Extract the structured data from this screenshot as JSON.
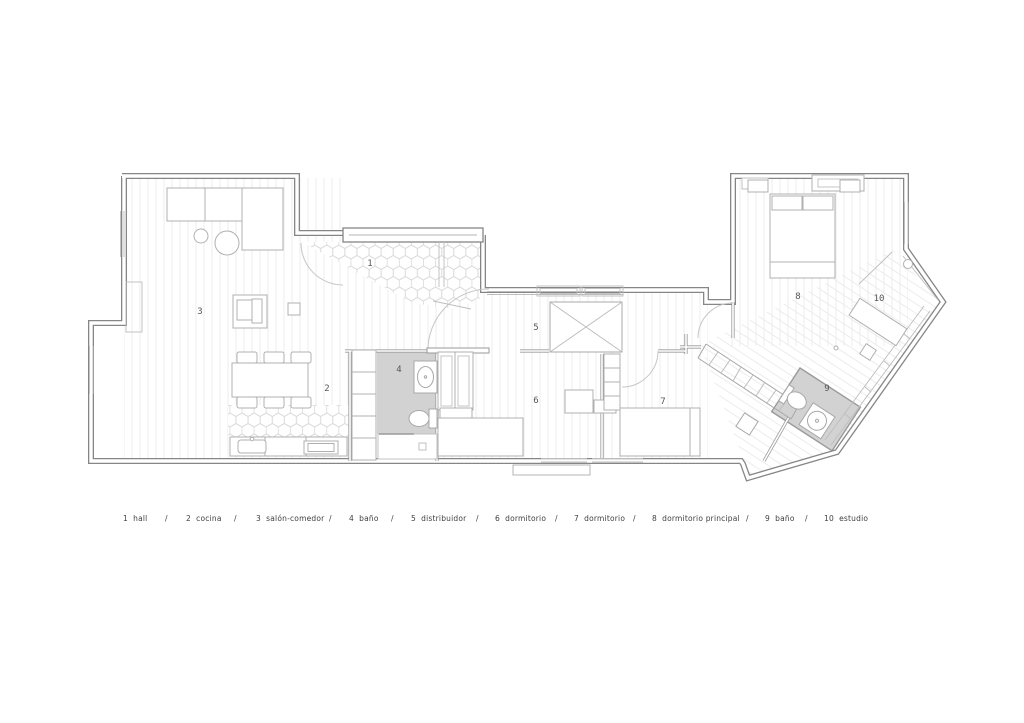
{
  "plan": {
    "rooms": [
      {
        "number": "1",
        "name": "hall"
      },
      {
        "number": "2",
        "name": "cocina"
      },
      {
        "number": "3",
        "name": "salón-comedor"
      },
      {
        "number": "4",
        "name": "baño"
      },
      {
        "number": "5",
        "name": "distribuidor"
      },
      {
        "number": "6",
        "name": "dormitorio"
      },
      {
        "number": "7",
        "name": "dormitorio"
      },
      {
        "number": "8",
        "name": "dormitorio principal"
      },
      {
        "number": "9",
        "name": "baño"
      },
      {
        "number": "10",
        "name": "estudio"
      }
    ]
  },
  "legend": {
    "separator": "/",
    "items": [
      {
        "label": "1  hall"
      },
      {
        "label": "2  cocina"
      },
      {
        "label": "3  salón-comedor"
      },
      {
        "label": "4  baño"
      },
      {
        "label": "5  distribuidor"
      },
      {
        "label": "6  dormitorio"
      },
      {
        "label": "7  dormitorio"
      },
      {
        "label": "8  dormitorio principal"
      },
      {
        "label": "9  baño"
      },
      {
        "label": "10  estudio"
      }
    ]
  },
  "colors": {
    "exterior_wall": "#868686",
    "partition_wall": "#9a9a9a",
    "furniture_line": "#b0b0b0",
    "floor_plank_line": "#ececec",
    "hex_tile_line": "#dadada",
    "bathroom_floor": "#d2d2d2",
    "door_arc": "#c6c6c6",
    "label_text": "#4a4a4a",
    "background": "#ffffff"
  }
}
